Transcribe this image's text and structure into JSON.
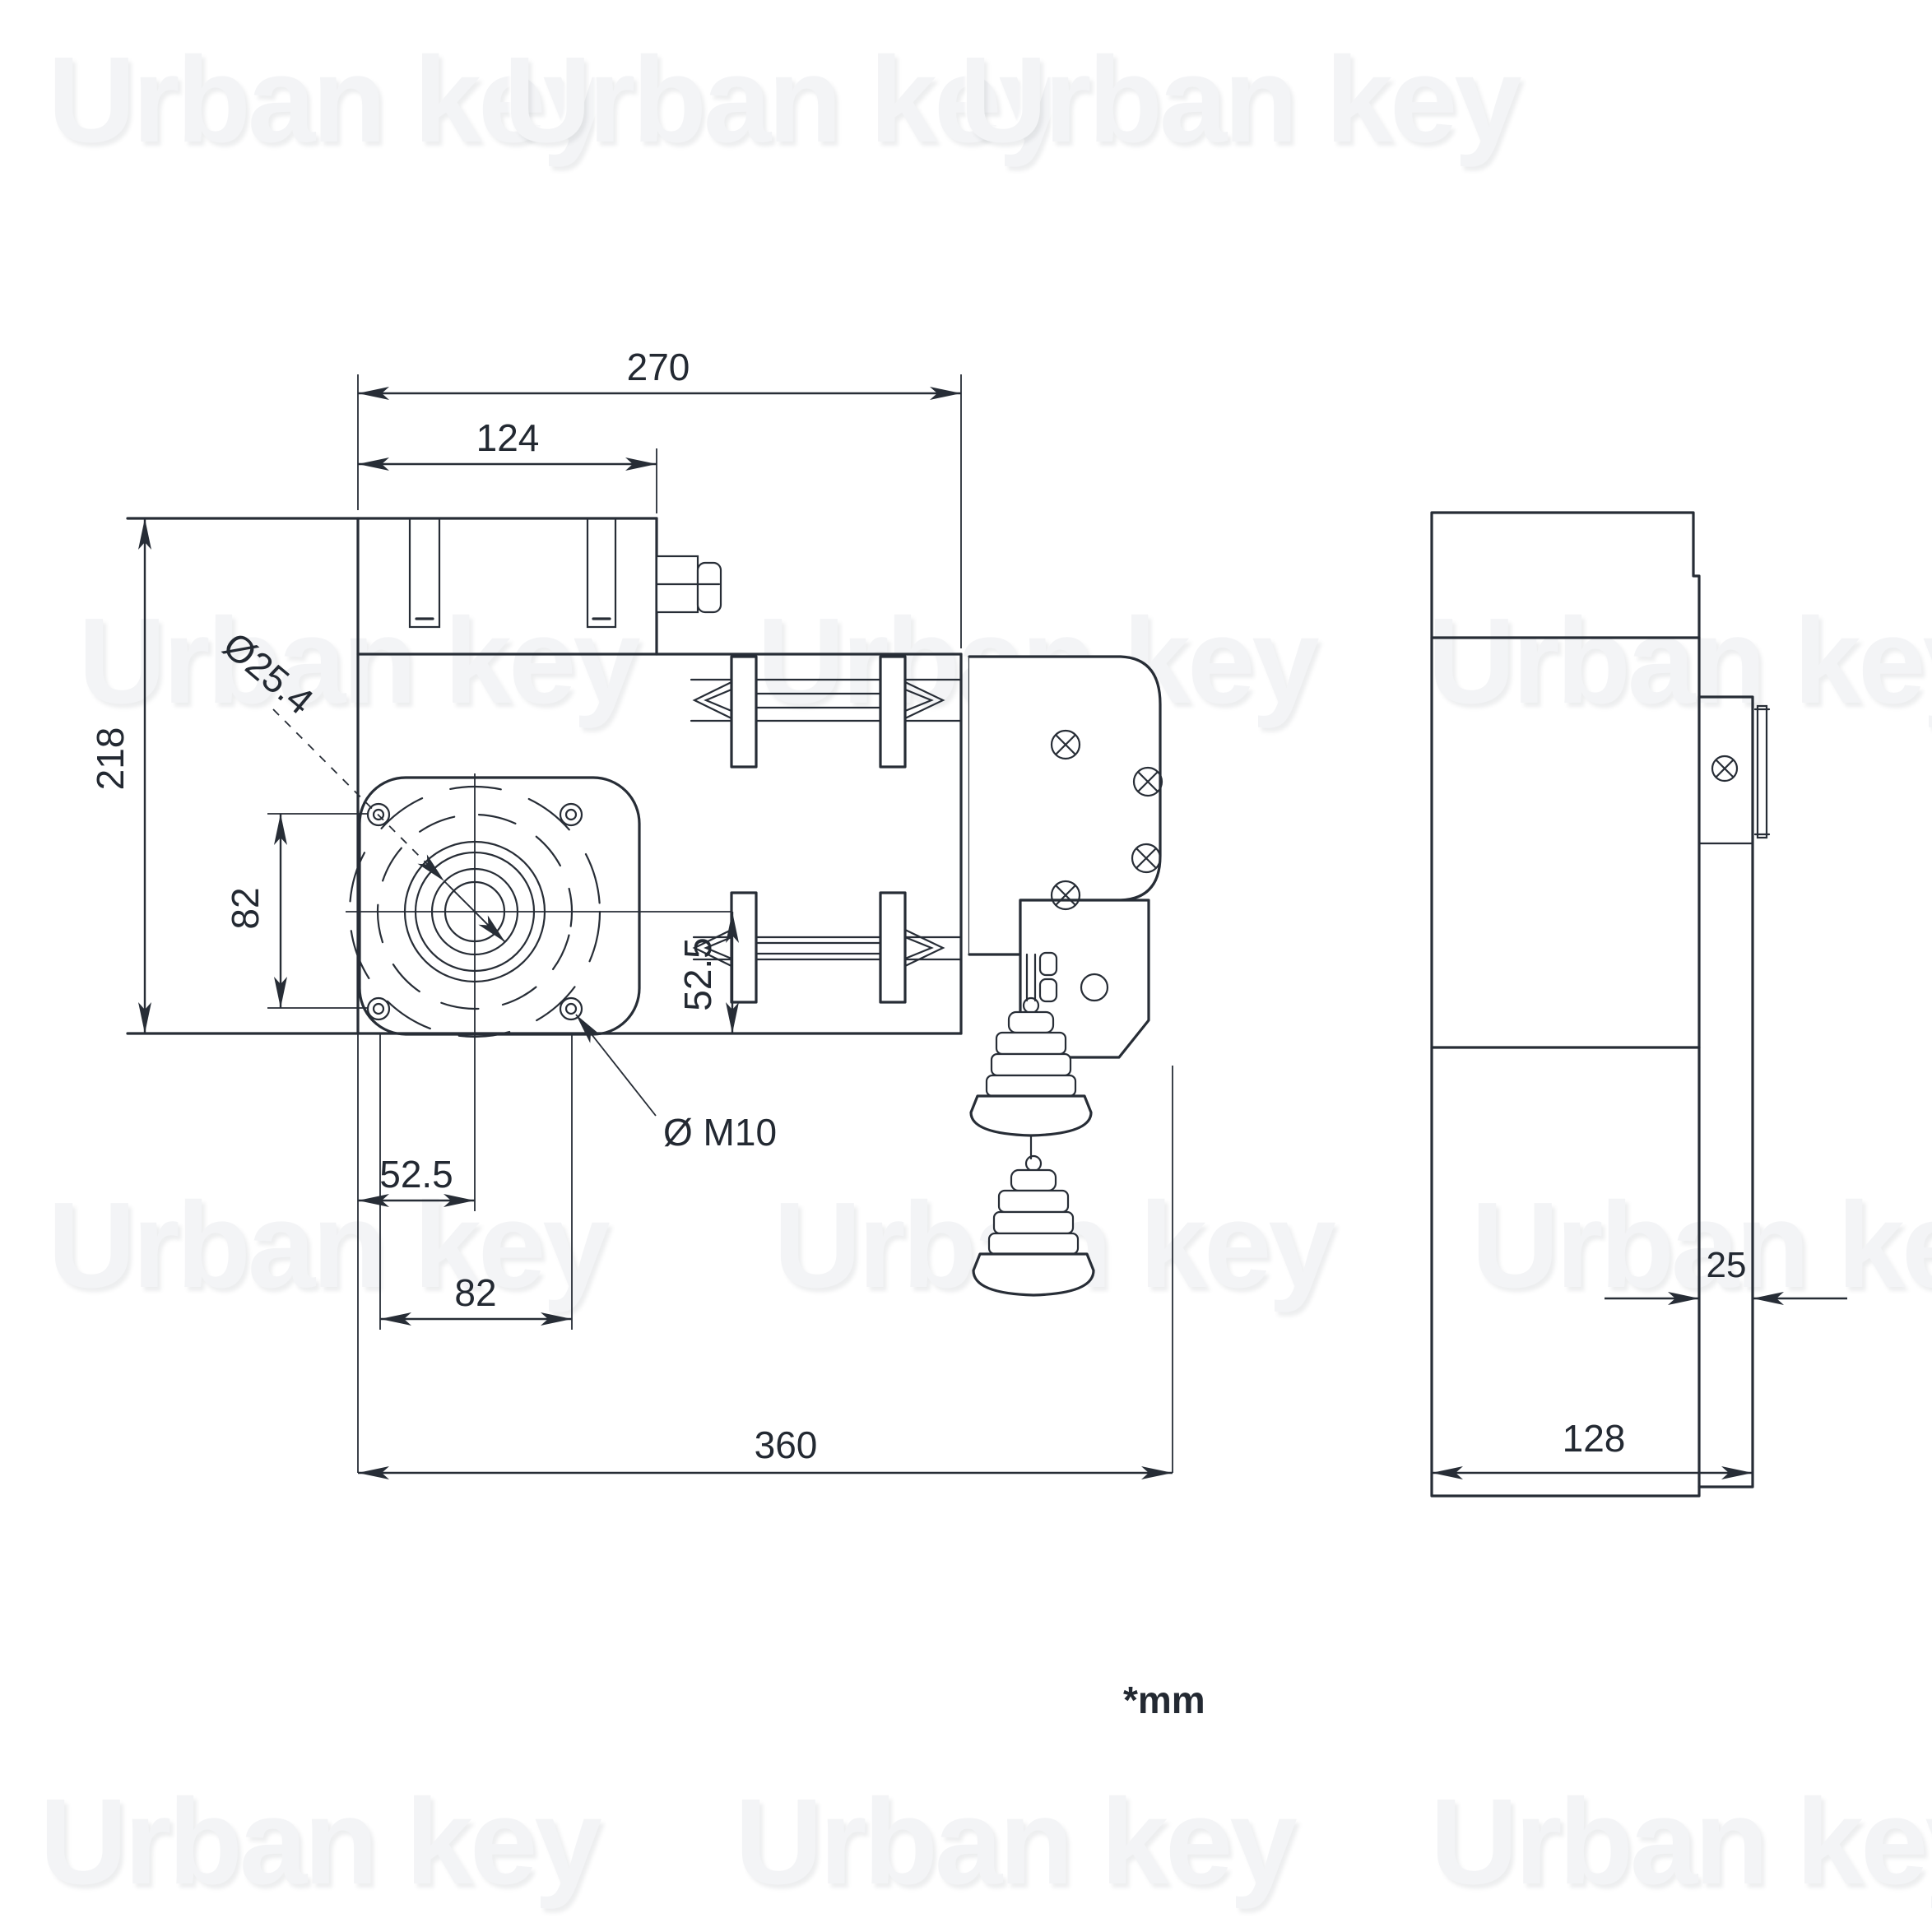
{
  "title": "Chain hoist door motor - dimensional technical drawing",
  "units_note": "*mm",
  "watermark": {
    "text": "Urban key",
    "color": "#f3f4f6"
  },
  "colors": {
    "line": "#272d36",
    "background": "#ffffff"
  },
  "views": {
    "front": {
      "name": "front view",
      "dims": {
        "overall_width_top": "270",
        "top_block_width": "124",
        "overall_height": "218",
        "flange_hole_spacing_vertical": "82",
        "bore_diameter": "Ø25.4",
        "center_to_bottom": "52.5",
        "mounting_hole_thread": "Ø M10",
        "edge_to_center": "52.5",
        "flange_hole_spacing_horizontal": "82",
        "overall_width_with_bracket": "360"
      }
    },
    "side": {
      "name": "side view",
      "dims": {
        "rail_depth": "25",
        "overall_depth": "128"
      }
    }
  }
}
